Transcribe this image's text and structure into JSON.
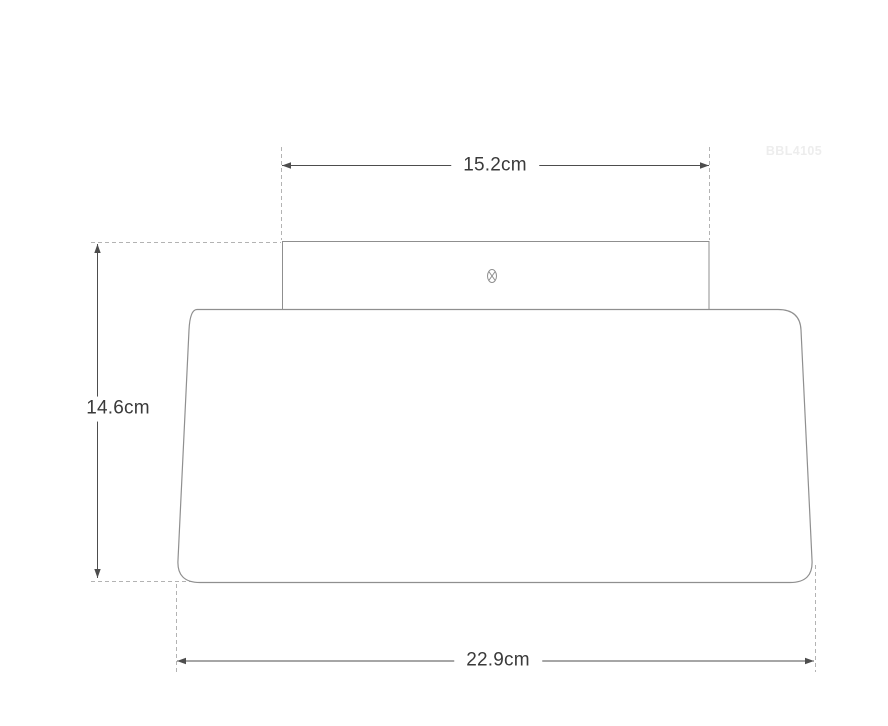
{
  "diagram": {
    "watermark": "BBL4105",
    "dimensions": [
      {
        "name": "top-width",
        "value": "15.2cm"
      },
      {
        "name": "height",
        "value": "14.6cm"
      },
      {
        "name": "bottom-width",
        "value": "22.9cm"
      }
    ],
    "icons": {
      "screw": "phillips-screw-head-icon"
    },
    "colors": {
      "background": "#ffffff",
      "product_outline": "#8f8f8f",
      "dimension_line": "#4d4d4d",
      "extension_line": "#b3b3b3",
      "label_text": "#3a3a3a",
      "watermark_text": "#ededed"
    }
  }
}
